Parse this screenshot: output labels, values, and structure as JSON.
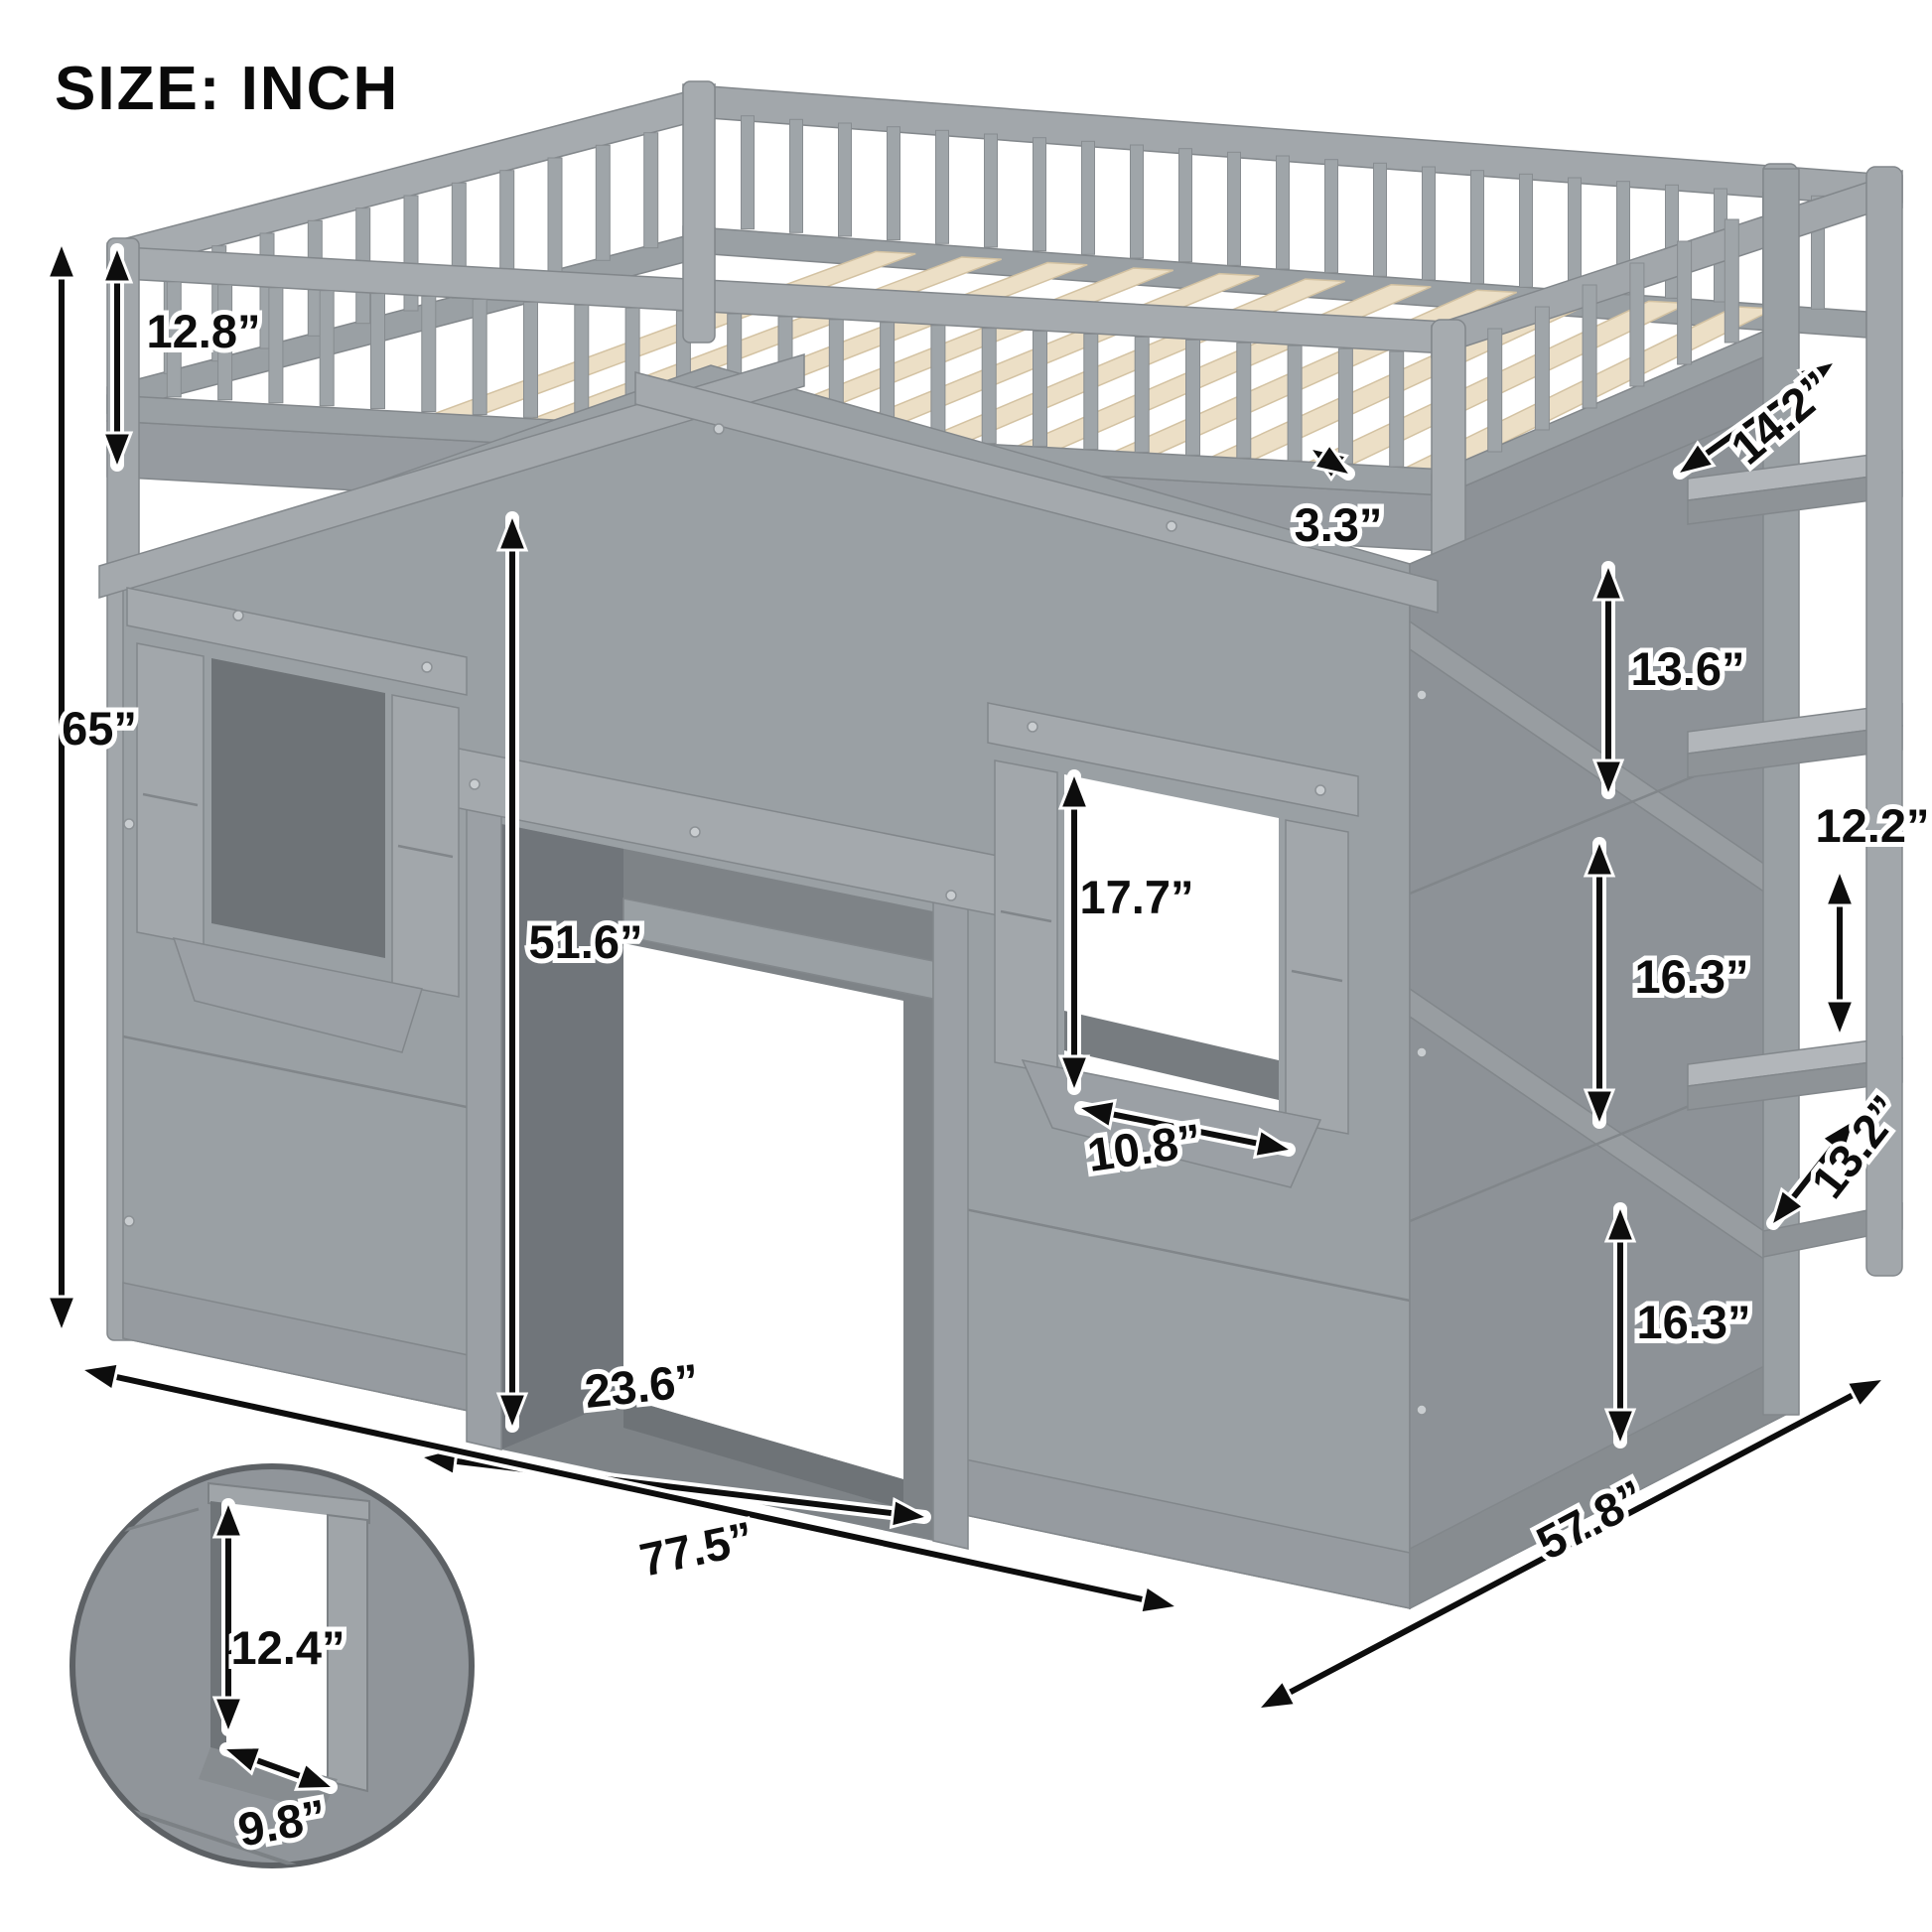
{
  "title": "SIZE: INCH",
  "unit": "INCH",
  "dimensions": {
    "rail_height": "12.8”",
    "overall_height": "65”",
    "corner_depth": "14.2”",
    "slat_spacing": "3.3”",
    "right_panel_upper": "13.6”",
    "ladder_step_gap": "12.2”",
    "right_panel_middle": "16.3”",
    "ladder_bottom_gap": "13.2”",
    "right_panel_lower": "16.3”",
    "bed_depth": "57.8”",
    "door_height": "51.6”",
    "window_height": "17.7”",
    "window_width": "10.8”",
    "door_width": "23.6”",
    "bed_width": "77.5”",
    "inset_window_height": "12.4”",
    "inset_window_width": "9.8”"
  },
  "colors": {
    "frame_gray": "#9aa0a4",
    "side_gray": "#8d9297",
    "interior_gray": "#6e7377",
    "slat_wood": "#ecdfc6",
    "dimension_line": "#0d0d0d",
    "background": "#ffffff"
  }
}
